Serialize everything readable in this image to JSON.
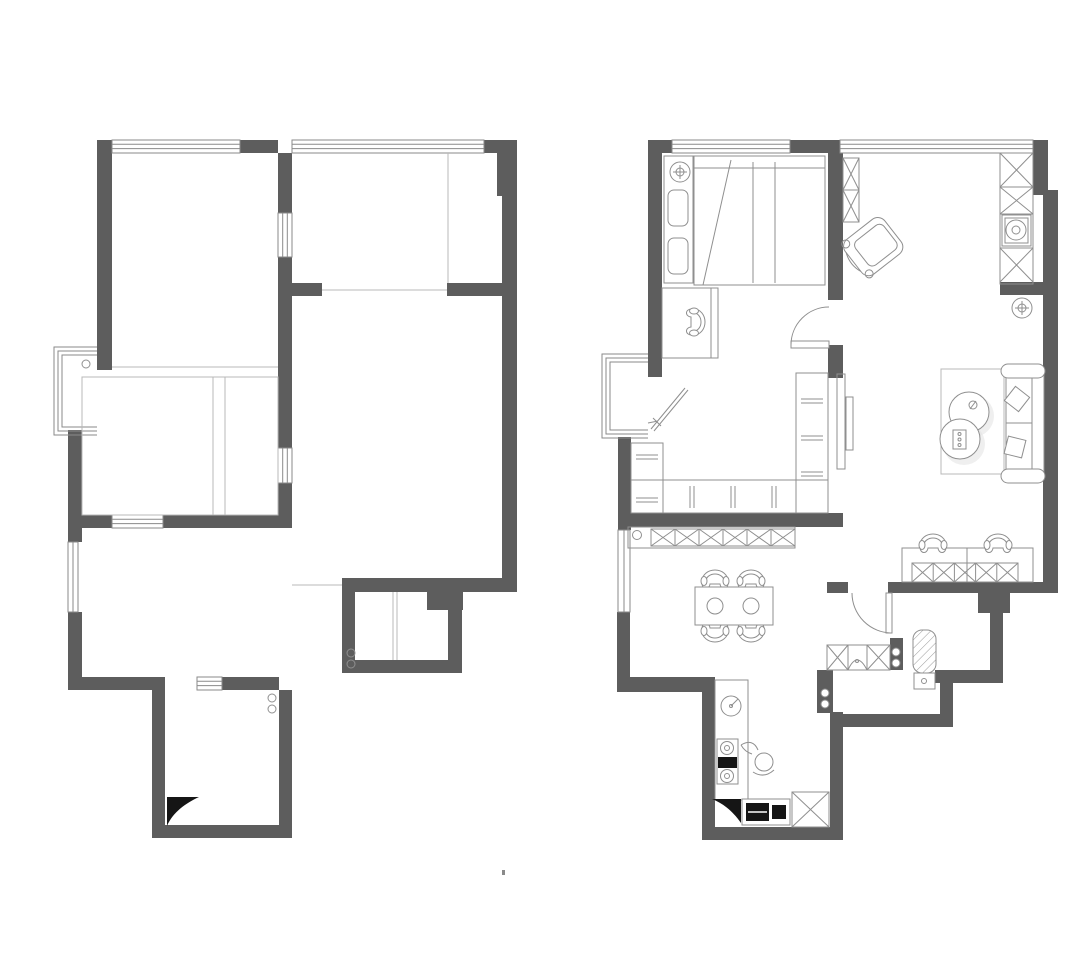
{
  "image": {
    "width": 1080,
    "height": 960,
    "kind": "architectural-floor-plan-pair",
    "view_box": "0 0 1080 960",
    "background": "#ffffff"
  },
  "colors": {
    "wall": "#5d5d5d",
    "furniture_line": "#8f8f8f",
    "partition_line": "#b8b8b8",
    "window_line": "#8a8a8a",
    "black_fill": "#151515",
    "shadow": "#e2e2e2",
    "white": "#ffffff"
  },
  "plans": [
    {
      "id": "left-plan",
      "kind": "structural-shell-plan",
      "position": "left",
      "features": [
        "exterior-walls",
        "window-openings",
        "bay-window",
        "interior-partition-lines",
        "filled-door-leaf",
        "plumbing-riser-circles",
        "door-openings"
      ]
    },
    {
      "id": "right-plan",
      "kind": "furnished-layout-plan",
      "position": "right",
      "rooms": [
        {
          "name": "bedroom",
          "items": [
            "ceiling-fan-symbol",
            "wardrobe-column",
            "double-bed",
            "writing-desk",
            "desk-chair",
            "swing-door"
          ]
        },
        {
          "name": "living-room",
          "items": [
            "lounge-chair",
            "wall-cabinet-strip",
            "tall-cabinet-column",
            "washing-machine",
            "floor-drain-symbol",
            "sofa",
            "throw-pillows",
            "nesting-coffee-tables",
            "area-rug",
            "tv-panel",
            "study-desk",
            "desk-chairs",
            "under-desk-cabinets"
          ]
        },
        {
          "name": "walk-in-closet",
          "items": [
            "u-shaped-wardrobe",
            "hanging-rails",
            "full-length-mirror",
            "sideboard-cabinet"
          ]
        },
        {
          "name": "dining-area",
          "items": [
            "dining-table",
            "dining-chairs",
            "place-settings"
          ]
        },
        {
          "name": "kitchen",
          "items": [
            "l-shaped-counter",
            "round-sink",
            "two-burner-cooktop",
            "cook-figure",
            "oven-appliances",
            "storage-x-cabinet",
            "filled-door-leaf"
          ]
        },
        {
          "name": "bathroom",
          "items": [
            "swing-door",
            "vanity-with-basin",
            "toilet",
            "door-stub-circles"
          ]
        },
        {
          "name": "balcony-bay",
          "items": [
            "bay-window"
          ]
        }
      ]
    }
  ]
}
